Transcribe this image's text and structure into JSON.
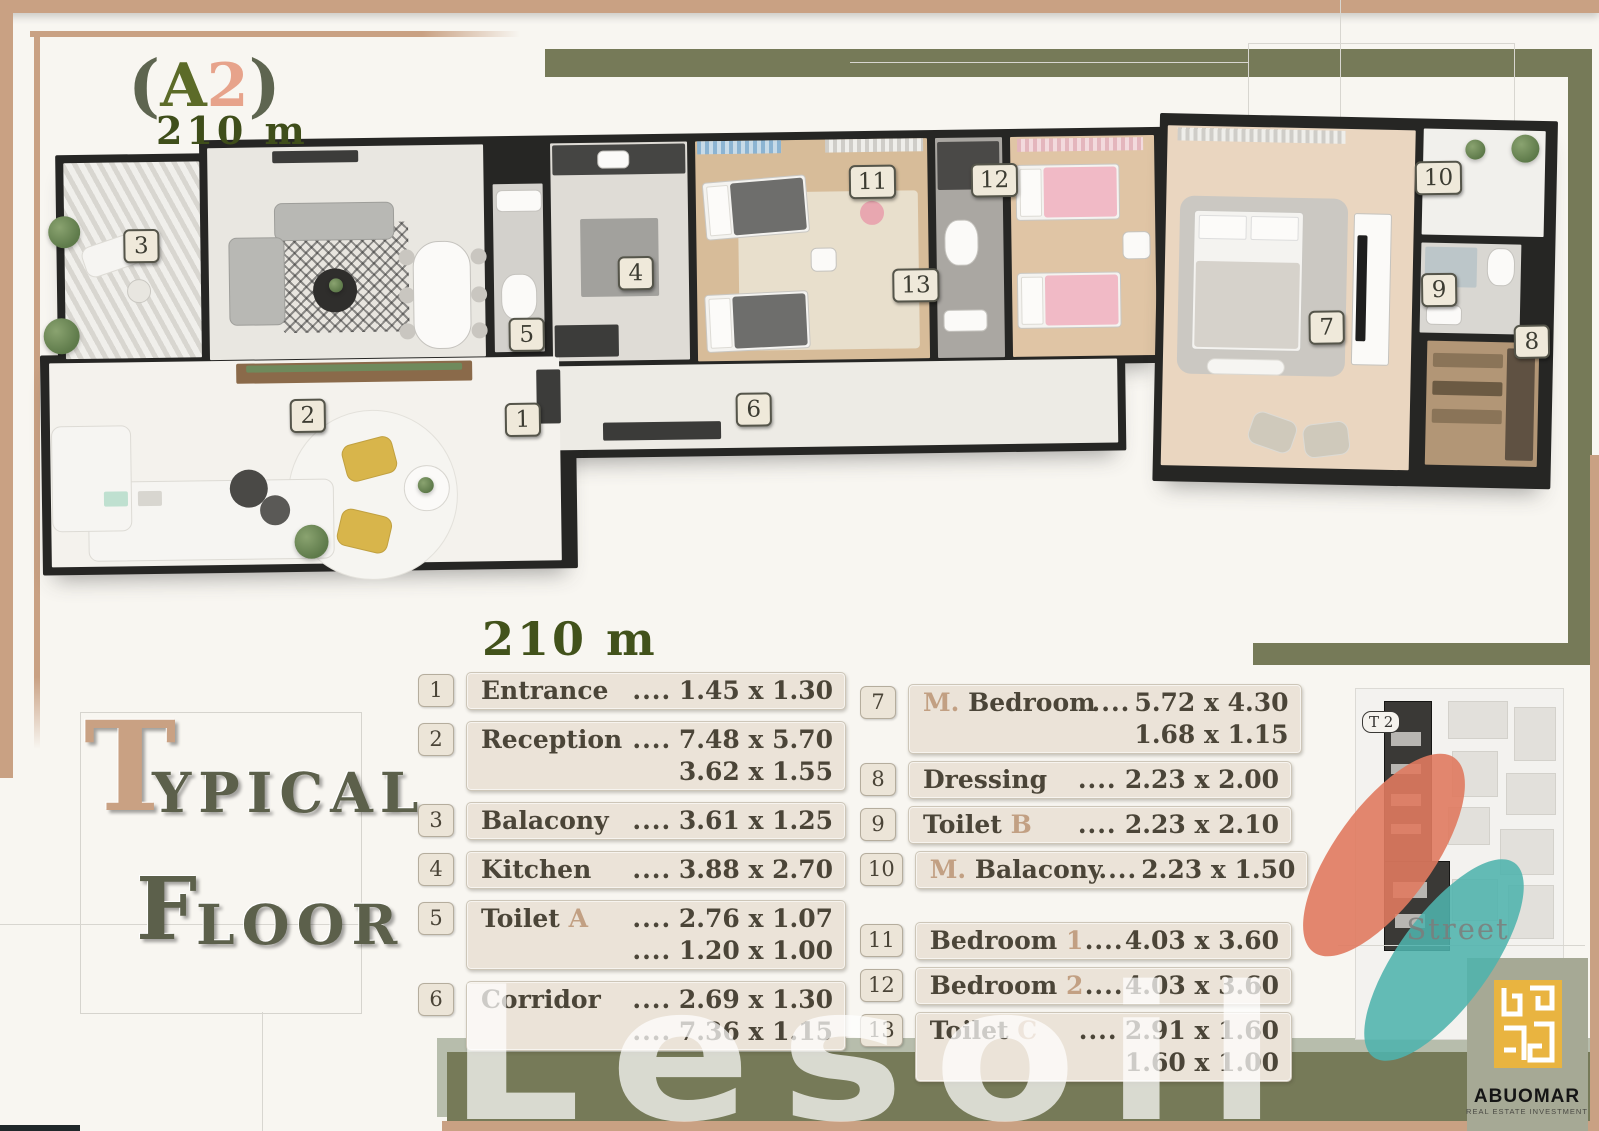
{
  "colors": {
    "tan": "#c9a183",
    "accent_tan": "#c2a083",
    "olive": "#767a58",
    "sage": "#b7bdac",
    "salmon": "#e7a38b",
    "gold": "#e9b440",
    "coral": "#e07a5f",
    "teal": "#4fb3ad"
  },
  "header": {
    "open": "(",
    "letter": "A",
    "number": "2",
    "close": ")",
    "area": "210 m"
  },
  "side_title": {
    "t_initial": "T",
    "t_rest": "YPICAL",
    "f_initial": "F",
    "f_rest": "LOOR"
  },
  "legend": {
    "heading": "210 m",
    "left": [
      {
        "num": "1",
        "pre": "Entrance",
        "accent": "",
        "post": "",
        "lines": [
          {
            "dots": "....",
            "value": "1.45 x 1.30"
          }
        ]
      },
      {
        "num": "2",
        "pre": "Reception",
        "accent": "",
        "post": "",
        "lines": [
          {
            "dots": "....",
            "value": "7.48 x 5.70"
          },
          {
            "dots": "",
            "value": "3.62 x 1.55"
          }
        ]
      },
      {
        "num": "3",
        "pre": "Balacony",
        "accent": "",
        "post": "",
        "lines": [
          {
            "dots": "....",
            "value": "3.61 x 1.25"
          }
        ]
      },
      {
        "num": "4",
        "pre": "Kitchen",
        "accent": "",
        "post": "",
        "lines": [
          {
            "dots": "....",
            "value": "3.88 x 2.70"
          }
        ]
      },
      {
        "num": "5",
        "pre": "Toilet ",
        "accent": "A",
        "post": "",
        "lines": [
          {
            "dots": "....",
            "value": "2.76 x 1.07"
          },
          {
            "dots": "....",
            "value": "1.20 x 1.00"
          }
        ]
      },
      {
        "num": "6",
        "pre": "Corridor",
        "accent": "",
        "post": "",
        "lines": [
          {
            "dots": "....",
            "value": "2.69 x 1.30"
          },
          {
            "dots": "....",
            "value": "7.36 x 1.15"
          }
        ]
      }
    ],
    "right": [
      {
        "num": "7",
        "pre": "",
        "accent": "M.",
        "post": " Bedroom",
        "lines": [
          {
            "dots": "....",
            "value": "5.72 x 4.30"
          },
          {
            "dots": "",
            "value": "1.68 x 1.15"
          }
        ]
      },
      {
        "num": "8",
        "pre": "Dressing",
        "accent": "",
        "post": "",
        "lines": [
          {
            "dots": "....",
            "value": "2.23 x 2.00"
          }
        ]
      },
      {
        "num": "9",
        "pre": "Toilet ",
        "accent": "B",
        "post": "",
        "lines": [
          {
            "dots": "....",
            "value": "2.23 x 2.10"
          }
        ]
      },
      {
        "num": "10",
        "pre": "",
        "accent": "M.",
        "post": " Balacony",
        "lines": [
          {
            "dots": "....",
            "value": "2.23 x 1.50"
          }
        ]
      },
      {
        "num": "11",
        "pre": "Bedroom ",
        "accent": "1",
        "post": "",
        "gap_before": true,
        "lines": [
          {
            "dots": "....",
            "value": "4.03 x 3.60"
          }
        ]
      },
      {
        "num": "12",
        "pre": "Bedroom ",
        "accent": "2",
        "post": "",
        "lines": [
          {
            "dots": "....",
            "value": "4.03 x 3.60"
          }
        ]
      },
      {
        "num": "13",
        "pre": "Toilet ",
        "accent": "C",
        "post": "",
        "lines": [
          {
            "dots": "....",
            "value": "2.91 x 1.60"
          },
          {
            "dots": "",
            "value": "1.60 x 1.00"
          }
        ]
      }
    ]
  },
  "plan": {
    "markers": [
      "1",
      "2",
      "3",
      "4",
      "5",
      "6",
      "7",
      "8",
      "9",
      "10",
      "11",
      "12",
      "13"
    ]
  },
  "map": {
    "unit_label": "T 2",
    "street_label": "Street"
  },
  "brand": {
    "name": "ABUOMAR",
    "tagline": "REAL ESTATE INVESTMENT",
    "watermark": "Lesoil"
  }
}
